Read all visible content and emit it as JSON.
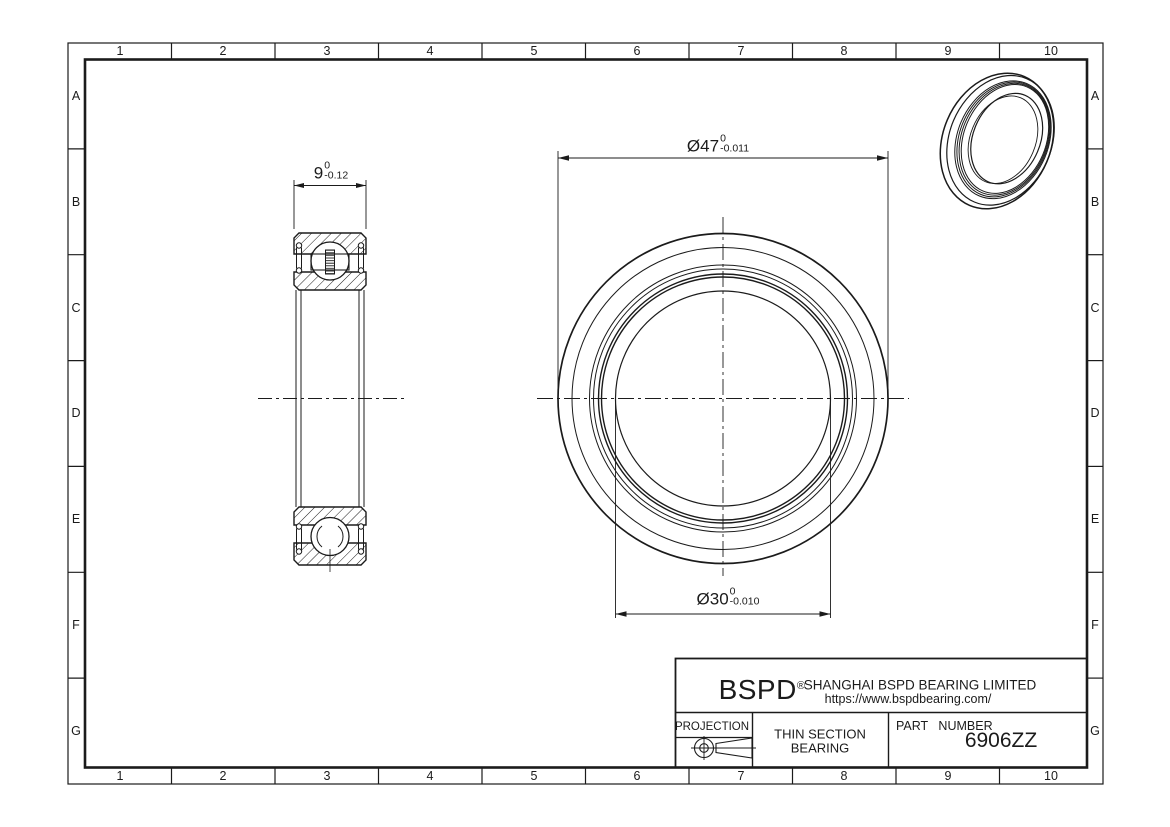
{
  "sheet": {
    "grid_columns": [
      "1",
      "2",
      "3",
      "4",
      "5",
      "6",
      "7",
      "8",
      "9",
      "10"
    ],
    "grid_rows": [
      "A",
      "B",
      "C",
      "D",
      "E",
      "F",
      "G"
    ]
  },
  "dimensions": {
    "width": {
      "value": "9",
      "tol_upper": "0",
      "tol_lower": "-0.12"
    },
    "outer_diameter": {
      "value": "Ø47",
      "tol_upper": "0",
      "tol_lower": "-0.011"
    },
    "bore_diameter": {
      "value": "Ø30",
      "tol_upper": "0",
      "tol_lower": "-0.010"
    }
  },
  "title_block": {
    "logo": "BSPD",
    "logo_reg": "®",
    "company": "SHANGHAI BSPD BEARING LIMITED",
    "website": "https://www.bspdbearing.com/",
    "projection_label": "PROJECTION",
    "product_line1": "THIN SECTION",
    "product_line2": "BEARING",
    "part_number_label": "PART NUMBER",
    "part_number": "6906ZZ"
  },
  "colors": {
    "line": "#1b1b1b",
    "background": "#ffffff"
  }
}
